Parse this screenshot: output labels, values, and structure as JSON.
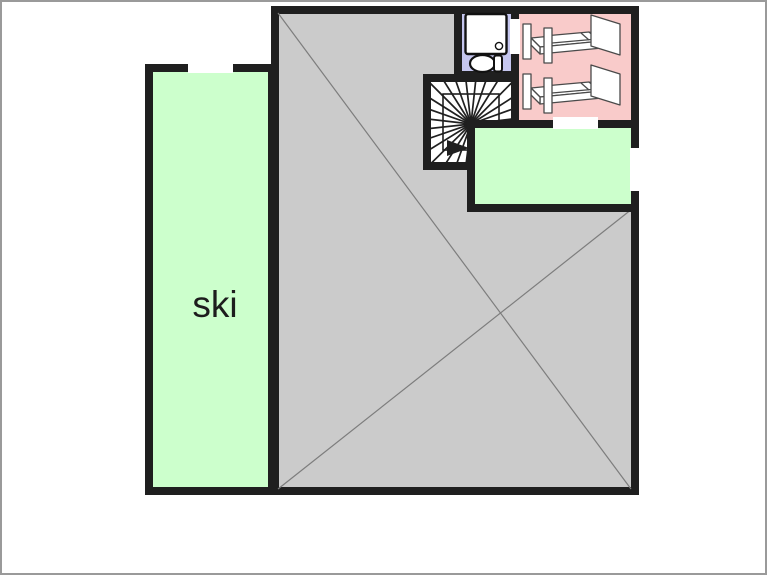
{
  "app": {
    "title": "Floor plan"
  },
  "colors": {
    "wall": "#1f1f1f",
    "background": "#ffffff",
    "frame_border": "#9a9a9a",
    "main_room_fill": "#cbcbcb",
    "diagonal_line": "#7d7d7d",
    "bathroom_fill": "#c5c6ef",
    "bunk_room_fill": "#f9cbca",
    "green_fill": "#ccffcc",
    "stair_fill": "#ffffff",
    "furniture_fill": "#ffffff",
    "furniture_stroke": "#4a4a4a",
    "label_color": "#1d1d1d"
  },
  "plan": {
    "canvas": {
      "width": 767,
      "height": 575
    },
    "wall_thickness": 8,
    "rooms": [
      {
        "id": "main-room",
        "name": "main room",
        "fill": "#cbcbcb",
        "rect": [
          273,
          8,
          360,
          481
        ],
        "diagonals": [
          [
            276,
            11,
            629,
            487
          ],
          [
            276,
            487,
            630,
            207
          ]
        ]
      },
      {
        "id": "stairwell",
        "name": "spiral staircase",
        "fill": "#ffffff",
        "rect": [
          425,
          76,
          88,
          88
        ]
      },
      {
        "id": "bathroom",
        "name": "bathroom",
        "fill": "#c5c6ef",
        "rect": [
          456,
          8,
          57,
          65
        ]
      },
      {
        "id": "bunk-room",
        "name": "bedroom with two beds",
        "fill": "#f9cbca",
        "rect": [
          513,
          8,
          120,
          114
        ]
      },
      {
        "id": "storage-room",
        "name": "small green room",
        "fill": "#ccffcc",
        "rect": [
          469,
          122,
          164,
          84
        ]
      },
      {
        "id": "ski-room",
        "name": "ski room",
        "fill": "#ccffcc",
        "rect": [
          147,
          66,
          123,
          423
        ],
        "label": "ski",
        "label_pos": [
          213,
          315
        ]
      }
    ],
    "door_openings": [
      {
        "id": "ski-room-door",
        "rect": [
          186,
          60,
          45,
          11
        ]
      },
      {
        "id": "bathroom-door",
        "rect": [
          508,
          17,
          10,
          35
        ]
      },
      {
        "id": "bunk-room-door",
        "rect": [
          551,
          115,
          45,
          12
        ]
      },
      {
        "id": "storage-room-door",
        "rect": [
          628,
          146,
          10,
          43
        ]
      }
    ],
    "stairs": {
      "center": [
        469,
        122
      ],
      "clip_polygon": [
        [
          429,
          80
        ],
        [
          509,
          80
        ],
        [
          509,
          118
        ],
        [
          465,
          118
        ],
        [
          465,
          160
        ],
        [
          429,
          160
        ]
      ],
      "tread_angle_start": 97,
      "tread_angle_end": 353,
      "tread_count": 21,
      "tread_length": 72,
      "railing_rect": [
        441,
        92,
        56,
        56
      ],
      "arrow_points": [
        [
          445,
          138
        ],
        [
          445,
          154
        ],
        [
          467,
          146
        ]
      ]
    },
    "bathroom_fixtures": {
      "shower_rect": [
        463.5,
        12,
        41,
        40
      ],
      "drain_circle": [
        497,
        44,
        3.6
      ],
      "toilet_bowl_ellipse": [
        480.5,
        61.5,
        12.5,
        8.5
      ],
      "toilet_tank_rect": [
        492,
        53.5,
        8,
        16
      ]
    },
    "beds": {
      "offsets_y": [
        0,
        50
      ],
      "paths": {
        "deck_top": "M529,36 L591,30 L600,39 L538,45 Z",
        "deck_front": "M538,45 L600,39 L600,46 L538,52 Z",
        "deck_end": "M529,36 L538,45 L538,52 L529,43 Z",
        "mattress": "M542,34 L587,30 L595,37 L550,41 Z",
        "pillow_line": "M579,31 L587,38",
        "post_near": "M521,22 L529,22 L529,57 L521,57 Z",
        "post_far": "M542,26 L550,26 L550,61 L542,61 Z",
        "headboard": "M589,13 L618,22 L618,53 L589,44 Z"
      }
    }
  }
}
